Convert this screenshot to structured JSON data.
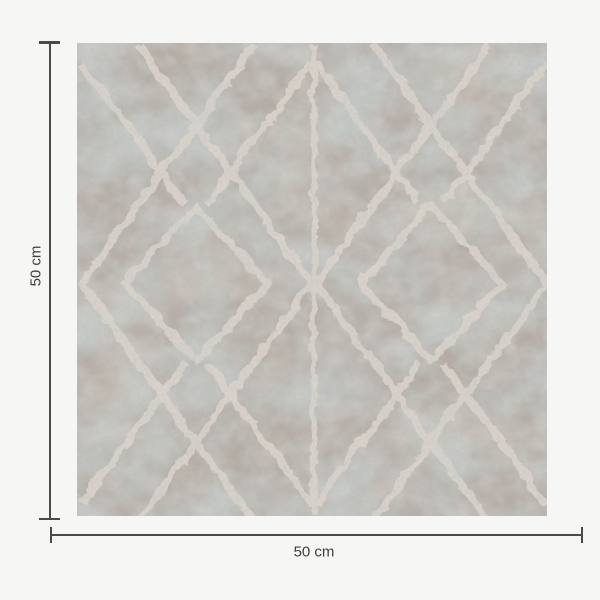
{
  "page": {
    "background_color": "#f6f6f4"
  },
  "product": {
    "name": "Distressed trellis patterned square tile swatch",
    "width_label": "50 cm",
    "height_label": "50 cm"
  },
  "dimension_annotation": {
    "line_color": "#4a4a4a",
    "label_color": "#3e3e3e"
  },
  "tile_palette": {
    "base": "#b4aba4",
    "mottle_blue_grey": "#8e9995",
    "mottle_mid": "#9aa39e",
    "mottle_warm": "#b29a86",
    "lattice_line": "#dbd3cb",
    "speckle_dark": "#6f7873"
  }
}
